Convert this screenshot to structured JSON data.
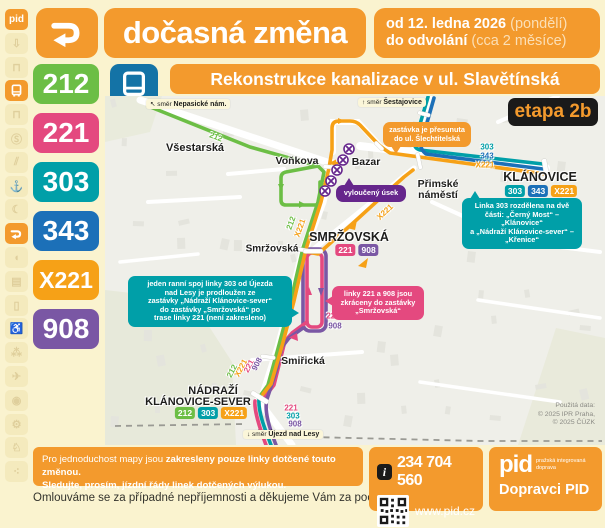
{
  "colors": {
    "orange": "#F39A2D",
    "green": "#6CBE45",
    "pink": "#E4497F",
    "teal": "#009FA8",
    "blue": "#1C70B8",
    "xorange": "#F6A117",
    "purple": "#7A57A4",
    "dark_purple": "#66268C",
    "black": "#1A1A1A",
    "bus_blue": "#1473A6"
  },
  "header": {
    "pid": "pid",
    "title": "dočasná změna",
    "validity": [
      {
        "bold": "od 12. ledna 2026",
        "normal": "(pondělí)"
      },
      {
        "bold": "do odvolání",
        "normal": "(cca 2 měsíce)"
      }
    ],
    "banner": "Rekonstrukce kanalizace v ul. Slavětínská",
    "stage": "etapa 2b"
  },
  "lines": [
    {
      "label": "212",
      "color": "#6CBE45"
    },
    {
      "label": "221",
      "color": "#E4497F"
    },
    {
      "label": "303",
      "color": "#009FA8"
    },
    {
      "label": "343",
      "color": "#1C70B8"
    },
    {
      "label": "X221",
      "color": "#F6A117"
    },
    {
      "label": "908",
      "color": "#7A57A4"
    }
  ],
  "sidebar": {
    "items": [
      {
        "name": "pid-logo",
        "glyph": "pid",
        "active": true
      },
      {
        "name": "detour-arrow-icon",
        "glyph": "⇩",
        "active": false
      },
      {
        "name": "tram-icon",
        "glyph": "⊓",
        "active": false
      },
      {
        "name": "bus-icon",
        "glyph": "svg:bus",
        "active": true
      },
      {
        "name": "trolleybus-icon",
        "glyph": "⊓",
        "active": false
      },
      {
        "name": "train-icon",
        "glyph": "Ⓢ",
        "active": false
      },
      {
        "name": "funicular-icon",
        "glyph": "⫽",
        "active": false
      },
      {
        "name": "ferry-icon",
        "glyph": "⚓",
        "active": false
      },
      {
        "name": "night-icon",
        "glyph": "☾",
        "active": false
      },
      {
        "name": "detour-route-icon",
        "glyph": "svg:zigzag",
        "active": true
      },
      {
        "name": "megaphone-icon",
        "glyph": "◖",
        "active": false
      },
      {
        "name": "money-icon",
        "glyph": "▤",
        "active": false
      },
      {
        "name": "phone-icon",
        "glyph": "▯",
        "active": false
      },
      {
        "name": "wheelchair-icon",
        "glyph": "♿",
        "active": false
      },
      {
        "name": "family-icon",
        "glyph": "⁂",
        "active": false
      },
      {
        "name": "plane-icon",
        "glyph": "✈",
        "active": false
      },
      {
        "name": "pram-icon",
        "glyph": "◉",
        "active": false
      },
      {
        "name": "bike-icon",
        "glyph": "⚙",
        "active": false
      },
      {
        "name": "dog-icon",
        "glyph": "♘",
        "active": false
      },
      {
        "name": "footprints-icon",
        "glyph": "⁖",
        "active": false
      }
    ]
  },
  "map": {
    "attribution": [
      "Použitá data:",
      "© 2025 IPR Praha,",
      "© 2025 ČÚZK"
    ],
    "direction_labels": [
      {
        "prefix": "↖ směr ",
        "name": "Nepasické nám.",
        "x": 146,
        "y": 99
      },
      {
        "prefix": "↑ směr ",
        "name": "Šestajovice",
        "x": 358,
        "y": 98
      },
      {
        "prefix": "↓ směr ",
        "name": "Újezd nad Lesy",
        "x": 243,
        "y": 430
      }
    ],
    "stop_labels": [
      {
        "text": "Všestarská",
        "x": 195,
        "y": 148,
        "size": 11
      },
      {
        "text": "Voňkova",
        "x": 297,
        "y": 161,
        "size": 10.5
      },
      {
        "text": "Bazar",
        "x": 366,
        "y": 162,
        "size": 10.5
      },
      {
        "text": "Přimské",
        "x": 438,
        "y": 184,
        "size": 10.5
      },
      {
        "text": "náměstí",
        "x": 438,
        "y": 195,
        "size": 10.5
      },
      {
        "text": "KLÁNOVICE",
        "x": 540,
        "y": 177,
        "size": 12.5
      },
      {
        "text": "SMRŽOVSKÁ",
        "x": 349,
        "y": 237,
        "size": 12.5
      },
      {
        "text": "Smržovská",
        "x": 272,
        "y": 249,
        "size": 10
      },
      {
        "text": "Smiřická",
        "x": 303,
        "y": 361,
        "size": 10.5
      },
      {
        "text": "NÁDRAŽÍ",
        "x": 213,
        "y": 391,
        "size": 11
      },
      {
        "text": "KLÁNOVICE-SEVER",
        "x": 198,
        "y": 402,
        "size": 11
      }
    ],
    "route_labels": [
      {
        "text": "212",
        "line": "green",
        "x": 216,
        "y": 137,
        "rot": 21
      },
      {
        "text": "212",
        "line": "green",
        "x": 291,
        "y": 223,
        "rot": -70
      },
      {
        "text": "X221",
        "line": "xorange",
        "x": 300,
        "y": 228,
        "rot": -70
      },
      {
        "text": "X221",
        "line": "xorange",
        "x": 385,
        "y": 212,
        "rot": -43
      },
      {
        "text": "303",
        "line": "teal",
        "x": 487,
        "y": 147,
        "rot": 0
      },
      {
        "text": "343",
        "line": "blue",
        "x": 487,
        "y": 156,
        "rot": 0
      },
      {
        "text": "X221",
        "line": "xorange",
        "x": 485,
        "y": 165,
        "rot": 0
      },
      {
        "text": "221",
        "line": "pink",
        "x": 333,
        "y": 316,
        "rot": 0
      },
      {
        "text": "908",
        "line": "purple",
        "x": 335,
        "y": 326,
        "rot": 0
      },
      {
        "text": "212",
        "line": "green",
        "x": 232,
        "y": 371,
        "rot": -62
      },
      {
        "text": "X221",
        "line": "xorange",
        "x": 241,
        "y": 368,
        "rot": -62
      },
      {
        "text": "221",
        "line": "pink",
        "x": 249,
        "y": 366,
        "rot": -62
      },
      {
        "text": "908",
        "line": "purple",
        "x": 257,
        "y": 364,
        "rot": -62
      },
      {
        "text": "221",
        "line": "pink",
        "x": 291,
        "y": 408,
        "rot": 0
      },
      {
        "text": "303",
        "line": "teal",
        "x": 293,
        "y": 416,
        "rot": 0
      },
      {
        "text": "908",
        "line": "purple",
        "x": 295,
        "y": 424,
        "rot": 0
      }
    ],
    "badge_groups": [
      {
        "x": 541,
        "y": 185,
        "items": [
          "303",
          "343",
          "X221"
        ]
      },
      {
        "x": 357,
        "y": 244,
        "items": [
          "221",
          "908"
        ]
      },
      {
        "x": 211,
        "y": 407,
        "items": [
          "212",
          "303",
          "X221"
        ]
      }
    ],
    "callouts": [
      {
        "name": "stop-moved-callout",
        "bg": "#F39A2D",
        "x": 383,
        "y": 122,
        "w": 88,
        "tail": "bl",
        "lines": [
          "zastávka je přesunuta",
          "do ul. Šlechtitelská"
        ]
      },
      {
        "name": "excluded-section-badge",
        "bg": "#66268C",
        "x": 336,
        "y": 185,
        "w": 70,
        "tail": "tl",
        "lines": [
          "vyloučený úsek"
        ]
      },
      {
        "name": "line-303-split-callout",
        "bg": "#009FA8",
        "x": 462,
        "y": 198,
        "w": 120,
        "tail": "tl",
        "lines": [
          "Linka 303 rozdělena na dvě",
          "části: „Černý Most“ – „Klánovice“",
          "a „Nádraží Klánovice-sever“ –",
          "„Křenice“"
        ]
      },
      {
        "name": "morning-trip-callout",
        "bg": "#009FA8",
        "x": 128,
        "y": 276,
        "w": 164,
        "tail": "r",
        "lines": [
          "jeden ranní spoj linky 303 od Újezda",
          "nad Lesy je prodloužen ze",
          "zastávky „Nádraží Klánovice-sever“",
          "do zastávky „Smržovská“ po",
          "trase linky 221 (není zakresleno)"
        ]
      },
      {
        "name": "lines-shortened-callout",
        "bg": "#E4497F",
        "x": 332,
        "y": 286,
        "w": 92,
        "tail": "l",
        "lines": [
          "linky 221 a 908 jsou",
          "zkráceny do zastávky",
          "„Smržovská“"
        ]
      }
    ]
  },
  "footer": {
    "note_normal": "Pro jednoduchost mapy jsou ",
    "note_bold": "zakresleny pouze linky dotčené touto změnou.",
    "note_line2": "Sledujte, prosím, jízdní řády linek dotčených výlukou.",
    "apology": "Omlouváme se za případné nepříjemnosti a děkujeme Vám za pochopení.",
    "info_icon": "i",
    "phone": "234 704 560",
    "web": "www.pid.cz",
    "pid_logo": "pid",
    "pid_tagline1": "pražská integrovaná",
    "pid_tagline2": "doprava",
    "operators": "Dopravci PID"
  }
}
